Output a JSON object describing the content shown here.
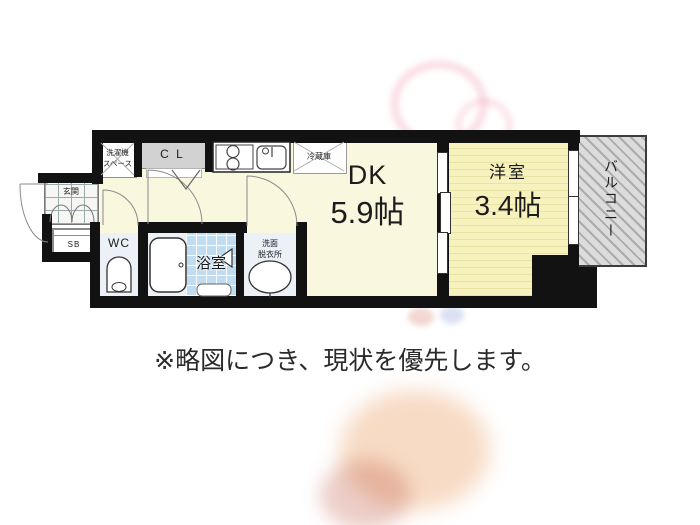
{
  "note": "※略図につき、現状を優先します。",
  "rooms": {
    "dk": {
      "label": "DK",
      "size": "5.9帖"
    },
    "western": {
      "label": "洋室",
      "size": "3.4帖"
    },
    "balcony": {
      "label": "バルコニー"
    },
    "bath": {
      "label": "浴室"
    },
    "washroom": {
      "line1": "洗面",
      "line2": "脱衣所"
    },
    "wc": {
      "label": "WC"
    },
    "entrance": {
      "label": "玄関"
    },
    "shoebox": {
      "label": "SB"
    },
    "closet": {
      "label": "C L"
    },
    "washer_space": {
      "line1": "洗濯機",
      "line2": "スペース"
    },
    "fridge": {
      "label": "冷蔵庫"
    }
  },
  "colors": {
    "wall": "#121212",
    "floor_cream": "#FAF7DF",
    "floor_western": "#F7F1BE",
    "bath_tile": "#C2DCEF",
    "wet_floor": "#ECF1F7",
    "closet_gray": "#D2D2D2",
    "balcony_gray": "#DCDCDC"
  }
}
